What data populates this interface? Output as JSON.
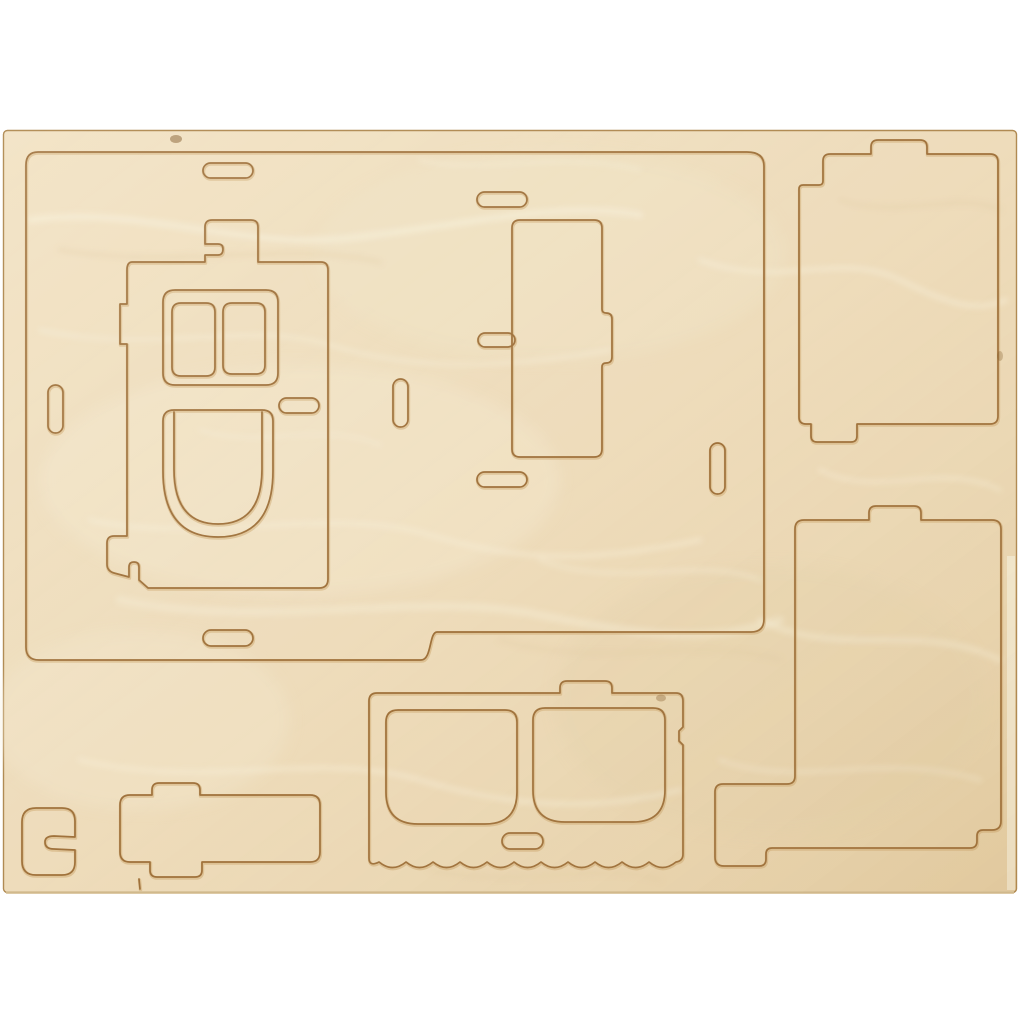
{
  "scene": {
    "description": "Top-down product photo of a light birch plywood sheet with laser pre-cut press-out pieces for a small wooden house construction kit, lying on a plain white background",
    "background_color": "#ffffff"
  },
  "sheet": {
    "material": "light birch plywood with soft wavy grain",
    "piece_count": 8,
    "slot_count": 10,
    "pieces": [
      {
        "id": "back-panel",
        "label": "large back panel with stepped bottom edge and slot holes"
      },
      {
        "id": "front-door-wall",
        "label": "front wall piece with twin windows, arched door and handle slot"
      },
      {
        "id": "narrow-side-strip",
        "label": "narrow vertical strip with side locking tab"
      },
      {
        "id": "roof-panel-top",
        "label": "rectangular panel with locking tabs, upper right"
      },
      {
        "id": "roof-panel-bottom",
        "label": "rectangular panel with locking tabs and notched corner, lower right"
      },
      {
        "id": "window-wall",
        "label": "wall piece with two rounded windows and scalloped lower edge"
      },
      {
        "id": "base-ledge",
        "label": "long ledge piece with top and bottom tabs"
      },
      {
        "id": "hook-block",
        "label": "small rounded block with hook-shaped side slot"
      }
    ]
  },
  "colors": {
    "background": "#ffffff",
    "wood_base": "#eedcbb",
    "wood_base_light": "#f3e5c7",
    "wood_light": "#f8f0da",
    "wood_shadow": "#e2cba0",
    "cut_line": "#996a33",
    "cut_glow": "#c9a266",
    "sheet_edge": "#b08a52",
    "sheet_side": "#f4ead0"
  }
}
